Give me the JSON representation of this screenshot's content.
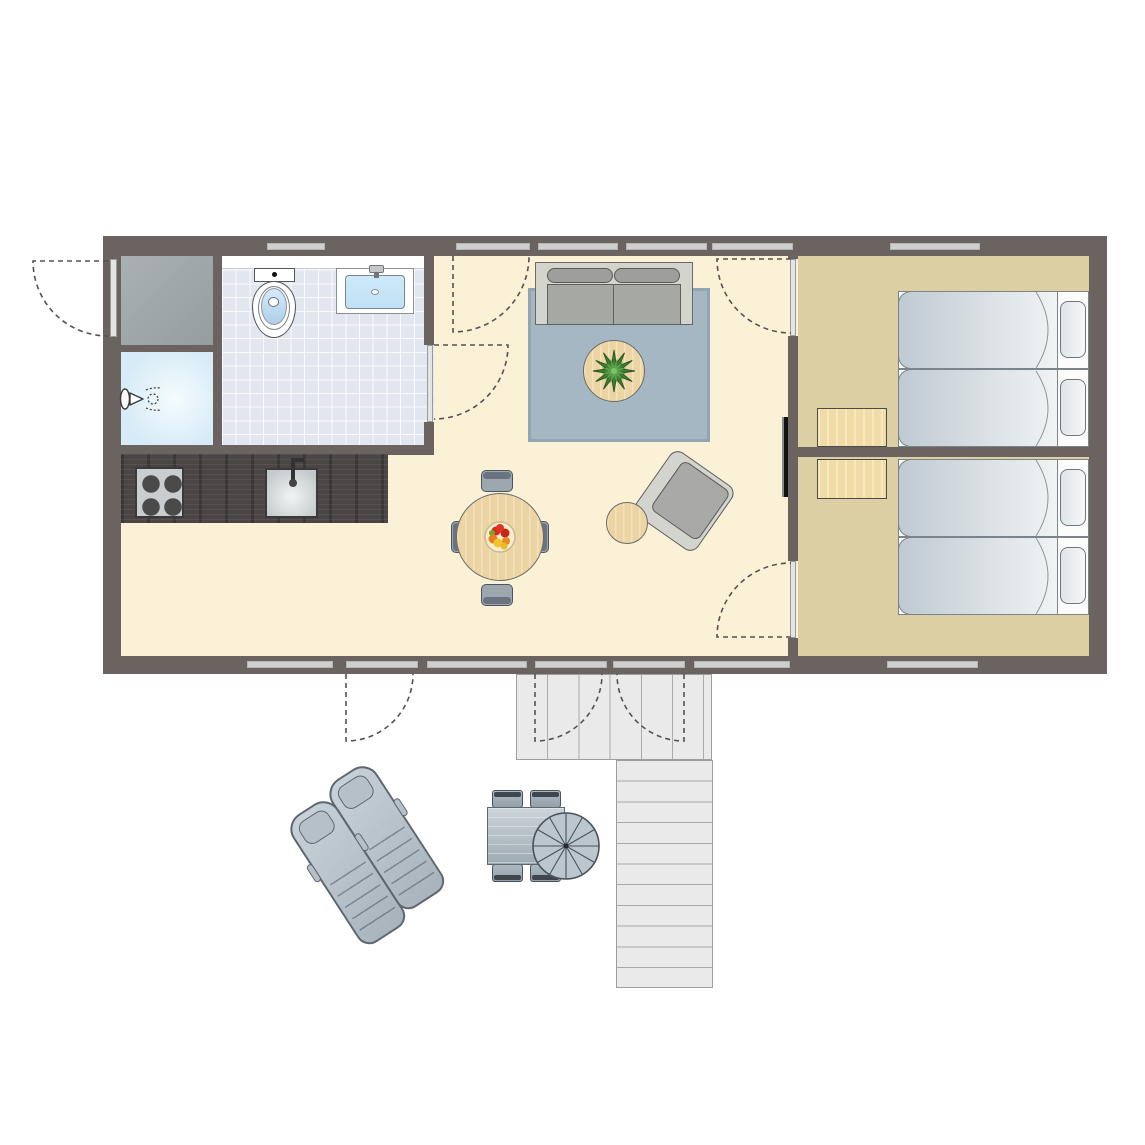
{
  "meta": {
    "kind": "floor-plan",
    "canvas_width_px": 1145,
    "canvas_height_px": 1145
  },
  "palette": {
    "wall": "#6B6360",
    "window-bar": "#CFCFCF",
    "floor-main": "#FAF1D7",
    "floor-bedroom": "#DCCFA4",
    "tile": "#E1E6EF",
    "shower": "#D6EBF7",
    "counter": "#4B4645",
    "wood": "#ECD5A3",
    "nightstand": "#F2DCA6",
    "rug": "#A6B7C4",
    "sofa-frame": "#D3D5CC",
    "cushion": "#A6A8A4",
    "duvet-from": "#BFCAD2",
    "duvet-to": "#F0F3F4",
    "deck": "#EAEAEA",
    "water": "#BFE1F5",
    "tv": "#111111",
    "plant-green": "#3F7D33",
    "fruit-red": "#D42B1F",
    "fruit-orange": "#E6801E",
    "fruit-yellow": "#EFC42E",
    "arc-stroke": "#55524F"
  },
  "labels": {
    "living": "living / dining / kitchen area",
    "bathroom": "bathroom",
    "bedroom1": "bedroom 1",
    "bedroom2": "bedroom 2",
    "deck": "deck",
    "stairs": "stairs",
    "sofa": "sofa",
    "rug": "rug",
    "coffee_table": "coffee table with plant",
    "armchair": "armchair",
    "side_table": "side table",
    "dining_table": "dining table with fruit bowl",
    "tv": "wall-mounted tv",
    "kitchen_counter": "kitchen counter",
    "stove": "4-burner stove",
    "kitchen_sink": "kitchen sink",
    "toilet": "toilet",
    "washbasin": "washbasin vanity",
    "shower": "shower",
    "closet": "storage closet",
    "bed": "single bed",
    "nightstand": "nightstand",
    "lounger": "sun lounger",
    "outdoor_table": "outdoor table",
    "parasol": "parasol",
    "entry_door": "entry door",
    "terrace_doors": "french terrace doors"
  },
  "counts": {
    "beds": 4,
    "pillows": 4,
    "nightstands": 2,
    "dining_chairs": 4,
    "outdoor_chairs": 4,
    "sun_loungers": 2,
    "deck_steps": 11,
    "top_wall_window_bars": 6,
    "bottom_wall_window_bars": 7,
    "door_swings": 8,
    "stove_burners": 4
  }
}
